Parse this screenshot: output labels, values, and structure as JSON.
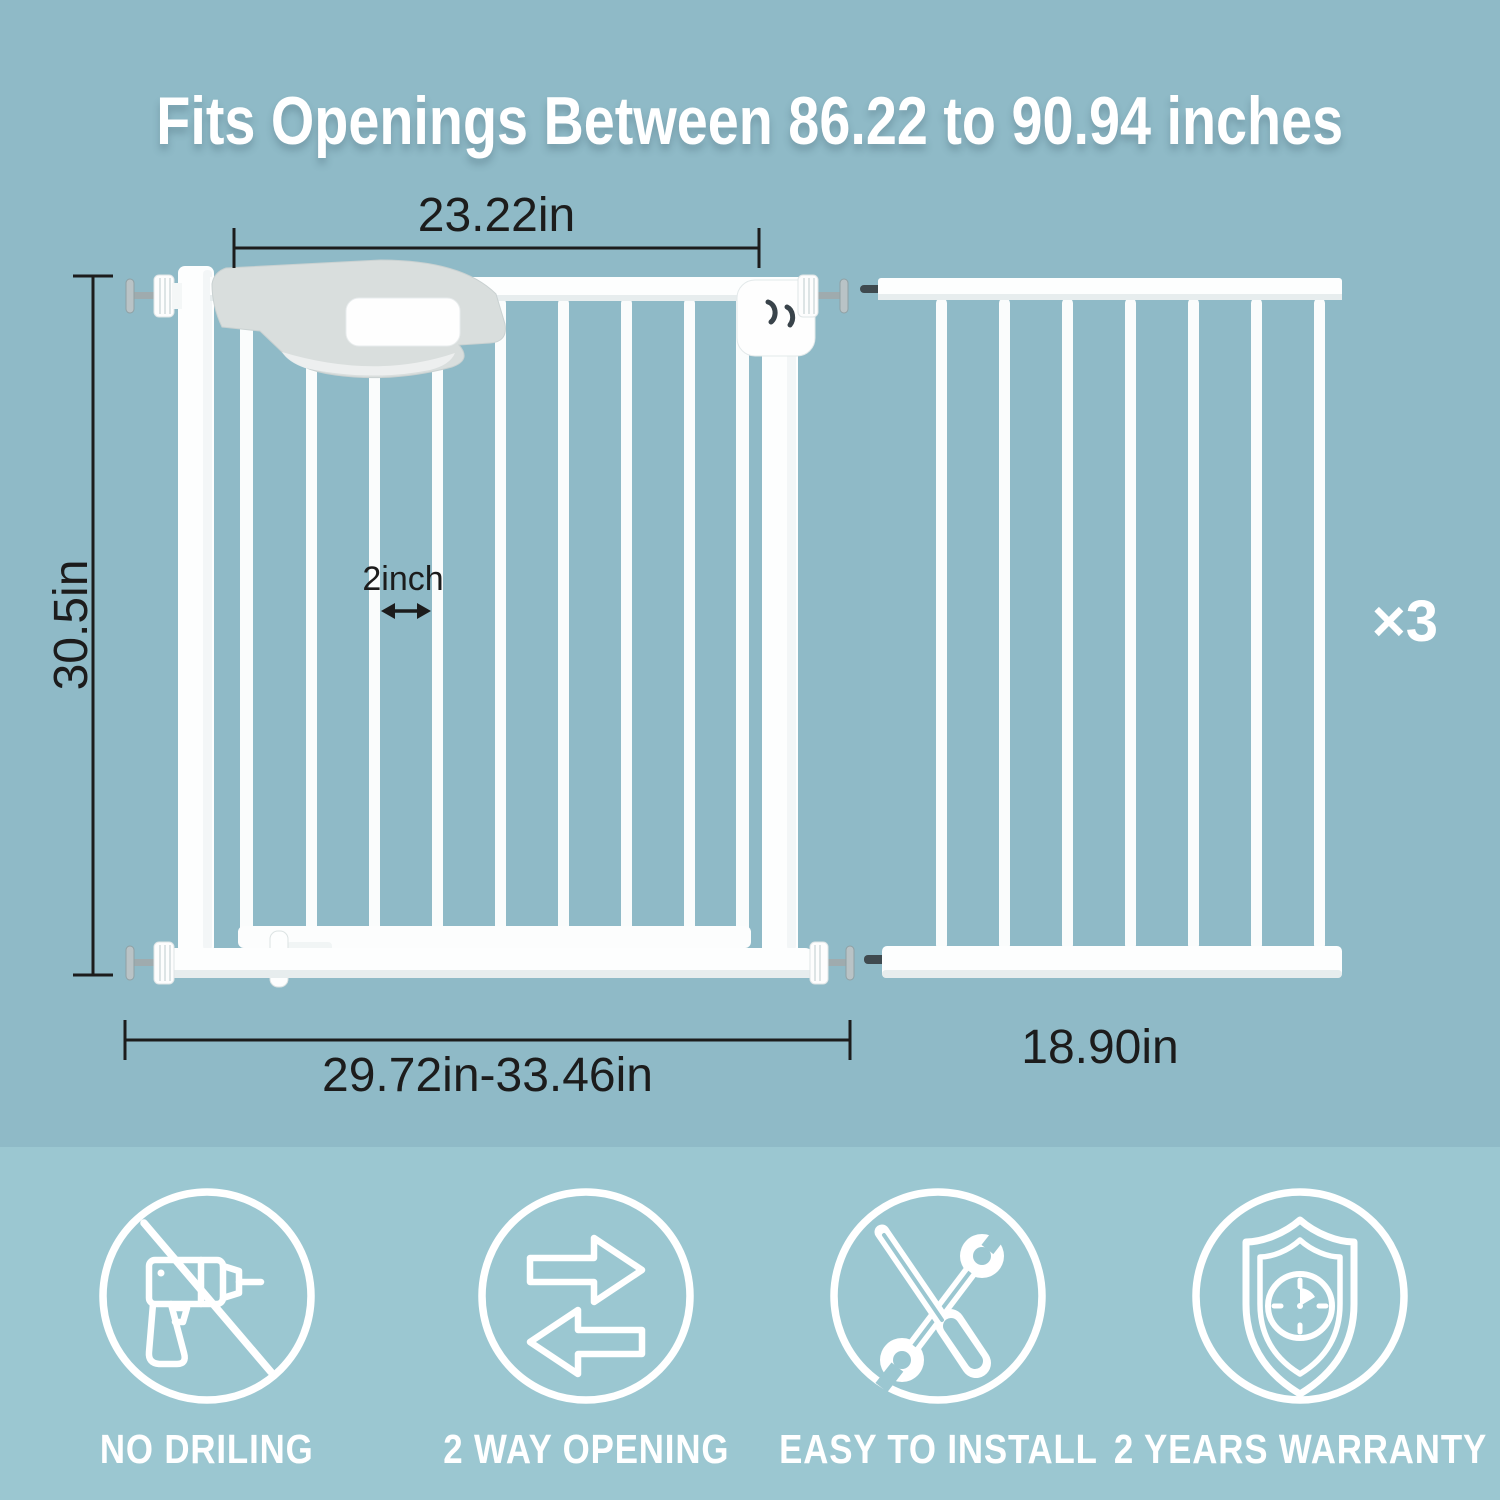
{
  "title": "Fits Openings Between 86.22 to 90.94 inches",
  "diagram": {
    "gate": {
      "door_width_label": "23.22in",
      "height_label": "30.5in",
      "bar_gap_label": "2inch",
      "width_range_label": "29.72in-33.46in"
    },
    "extension": {
      "width_label": "18.90in",
      "quantity_label": "×3"
    }
  },
  "features": [
    {
      "icon": "no-drilling-icon",
      "label": "NO DRILING"
    },
    {
      "icon": "two-way-opening-icon",
      "label": "2 WAY OPENING"
    },
    {
      "icon": "easy-to-install-icon",
      "label": "EASY TO INSTALL"
    },
    {
      "icon": "two-years-warranty-icon",
      "label": "2 YEARS WARRANTY"
    }
  ],
  "colors": {
    "top_background": "#8fbac7",
    "bottom_background": "#9bc7d1",
    "dimension_text": "#1c1c1c",
    "light_text": "#ffffff",
    "gate_white": "#fdfefe"
  }
}
